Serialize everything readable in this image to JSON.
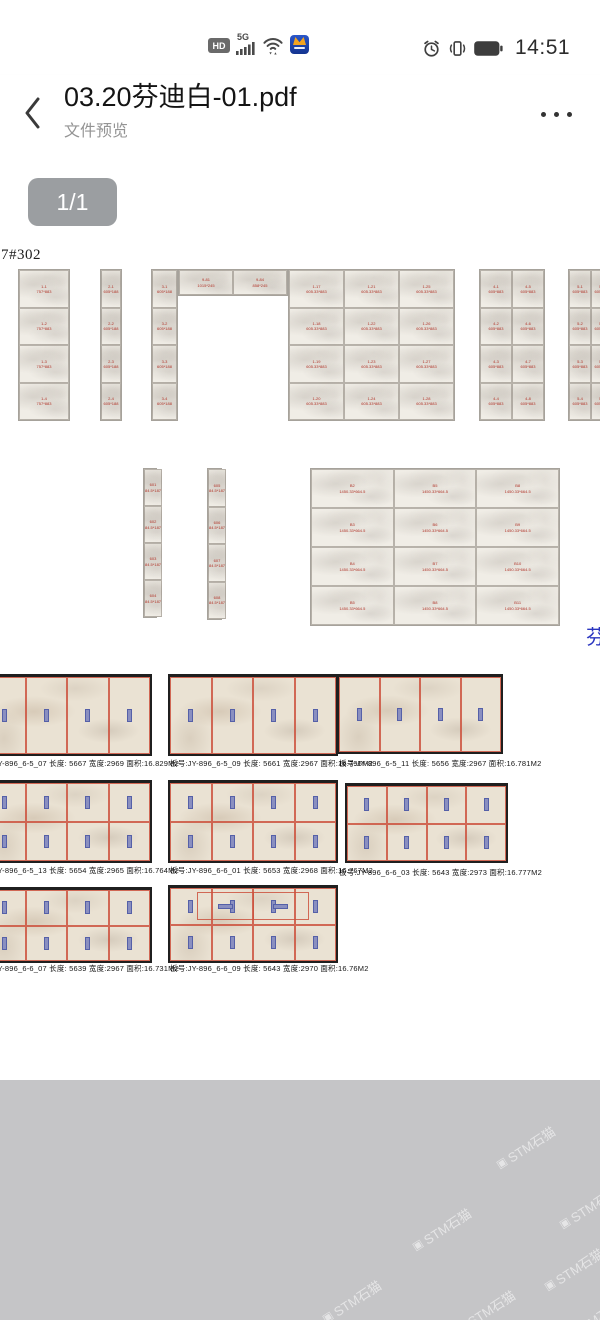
{
  "status_bar": {
    "time": "14:51",
    "hd_label": "HD",
    "network_label": "5G",
    "icons": [
      "hd-icon",
      "signal-bars-icon",
      "wifi-icon",
      "app-icon",
      "alarm-clock-icon",
      "vibrate-icon",
      "battery-icon"
    ]
  },
  "header": {
    "title": "03.20芬迪白-01.pdf",
    "subtitle": "文件预览"
  },
  "page_badge": "1/1",
  "drawing": {
    "corner_label": "07#302",
    "side_char": "芬",
    "tile_groups": [
      {
        "id": "panel-a",
        "x": 18,
        "y": 118,
        "w": 52,
        "h": 152,
        "cols": 1,
        "rows": 4,
        "labels": [
          "1-1\n757*883",
          "1-2\n757*883",
          "1-3\n757*883",
          "1-4\n757*883"
        ]
      },
      {
        "id": "panel-b",
        "x": 100,
        "y": 118,
        "w": 22,
        "h": 152,
        "cols": 1,
        "rows": 4,
        "labels": [
          "2-1\n605*188",
          "2-2\n605*188",
          "2-3\n605*188",
          "2-4\n605*188"
        ]
      },
      {
        "id": "door-left",
        "x": 151,
        "y": 118,
        "w": 27,
        "h": 152,
        "cols": 1,
        "rows": 4,
        "labels": [
          "3-1\n605*188",
          "3-2\n605*188",
          "3-3\n605*188",
          "3-4\n605*188"
        ]
      },
      {
        "id": "door-top",
        "x": 178,
        "y": 118,
        "w": 110,
        "h": 27,
        "cols": 2,
        "rows": 1,
        "labels": [
          "9-81\n1015*245",
          "9-84\n858*245"
        ]
      },
      {
        "id": "wall-main",
        "x": 288,
        "y": 118,
        "w": 167,
        "h": 152,
        "cols": 3,
        "rows": 4,
        "labels": [
          "1-17\n605.33*883",
          "1-21\n605.33*883",
          "1-25\n605.33*883",
          "1-18\n605.33*883",
          "1-22\n605.33*883",
          "1-26\n605.33*883",
          "1-19\n605.33*883",
          "1-23\n605.33*883",
          "1-27\n605.33*883",
          "1-20\n605.33*883",
          "1-24\n605.33*883",
          "1-28\n605.33*883"
        ]
      },
      {
        "id": "panel-d",
        "x": 479,
        "y": 118,
        "w": 66,
        "h": 152,
        "cols": 2,
        "rows": 4,
        "labels": [
          "4-1\n605*883",
          "4-5\n605*883",
          "4-2\n605*883",
          "4-6\n605*883",
          "4-3\n605*883",
          "4-7\n605*883",
          "4-4\n605*883",
          "4-8\n605*883"
        ]
      },
      {
        "id": "panel-e",
        "x": 568,
        "y": 118,
        "w": 46,
        "h": 152,
        "cols": 2,
        "rows": 4,
        "labels": [
          "5-1\n605*883",
          "5-5\n605*883",
          "5-2\n605*883",
          "5-6\n605*883",
          "5-3\n605*883",
          "5-7\n605*883",
          "5-4\n605*883",
          "5-8\n605*883"
        ]
      },
      {
        "id": "strip-a",
        "x": 143,
        "y": 317,
        "w": 14,
        "h": 150,
        "cols": 1,
        "rows": 4,
        "labels": [
          "601\n84.5*187",
          "602\n84.5*187",
          "603\n84.5*187",
          "604\n84.5*187"
        ]
      },
      {
        "id": "strip-b",
        "x": 207,
        "y": 317,
        "w": 15,
        "h": 152,
        "cols": 1,
        "rows": 4,
        "labels": [
          "605\n84.5*187",
          "606\n84.5*187",
          "607\n84.5*187",
          "608\n84.5*187"
        ]
      },
      {
        "id": "wall-lower",
        "x": 310,
        "y": 317,
        "w": 250,
        "h": 158,
        "cols": 3,
        "rows": 4,
        "labels": [
          "B2\n1450.33*664.5",
          "B5\n1450.33*664.5",
          "B8\n1450.33*664.5",
          "B3\n1450.33*664.5",
          "B6\n1450.33*664.5",
          "B9\n1450.33*664.5",
          "B4\n1450.33*664.5",
          "B7\n1450.33*664.5",
          "B10\n1450.33*664.5",
          "B5\n1450.33*664.5",
          "B8\n1450.33*664.5",
          "B11\n1450.33*664.5"
        ]
      }
    ]
  },
  "slabs": {
    "photos": [
      {
        "x": -18,
        "y": 523,
        "w": 170,
        "h": 82,
        "rows": 1,
        "cols": 4,
        "special": false
      },
      {
        "x": 168,
        "y": 523,
        "w": 170,
        "h": 82,
        "rows": 1,
        "cols": 4,
        "special": false
      },
      {
        "x": 337,
        "y": 523,
        "w": 166,
        "h": 80,
        "rows": 1,
        "cols": 4,
        "special": false
      },
      {
        "x": -18,
        "y": 629,
        "w": 170,
        "h": 83,
        "rows": 2,
        "cols": 4,
        "special": false
      },
      {
        "x": 168,
        "y": 629,
        "w": 170,
        "h": 83,
        "rows": 2,
        "cols": 4,
        "special": false
      },
      {
        "x": 345,
        "y": 632,
        "w": 163,
        "h": 80,
        "rows": 2,
        "cols": 4,
        "special": false
      },
      {
        "x": -18,
        "y": 736,
        "w": 170,
        "h": 76,
        "rows": 2,
        "cols": 4,
        "special": false
      },
      {
        "x": 168,
        "y": 734,
        "w": 170,
        "h": 78,
        "rows": 2,
        "cols": 4,
        "special": true
      }
    ],
    "captions": [
      {
        "x": -24,
        "y": 607,
        "text": "板号:JY-896_6-5_07 长度: 5667 宽度:2969 面积:16.829M2"
      },
      {
        "x": 170,
        "y": 607,
        "text": "板号:JY-896_6-5_09 长度: 5661 宽度:2967 面积:16.796M2"
      },
      {
        "x": 339,
        "y": 607,
        "text": "板号:JY-896_6-5_11 长度: 5656 宽度:2967 面积:16.781M2"
      },
      {
        "x": -24,
        "y": 714,
        "text": "板号:JY-896_6-5_13 长度: 5654 宽度:2965 面积:16.764M2"
      },
      {
        "x": 170,
        "y": 714,
        "text": "板号:JY-896_6-6_01 长度: 5653 宽度:2968 面积:16.767M2"
      },
      {
        "x": 339,
        "y": 716,
        "text": "板号:JY-896_6-6_03 长度: 5643 宽度:2973 面积:16.777M2"
      },
      {
        "x": -24,
        "y": 812,
        "text": "板号:JY-896_6-6_07 长度: 5639 宽度:2967 面积:16.731M2"
      },
      {
        "x": 170,
        "y": 812,
        "text": "板号:JY-896_6-6_09 长度: 5643 宽度:2970 面积:16.76M2"
      }
    ]
  },
  "watermark": {
    "icon": "▣",
    "text": "STM石猫",
    "positions": [
      {
        "x": 492,
        "y": 58
      },
      {
        "x": 555,
        "y": 118
      },
      {
        "x": 408,
        "y": 140
      },
      {
        "x": 540,
        "y": 180
      },
      {
        "x": 318,
        "y": 212
      },
      {
        "x": 452,
        "y": 222
      },
      {
        "x": 558,
        "y": 232
      }
    ]
  },
  "colors": {
    "badge_bg": "#9b9ea1",
    "tile_label_red": "#b13328",
    "grid_red": "#cd523e",
    "mark_blue": "#8a8fc0",
    "side_char_blue": "#2a35c0",
    "footer_gray": "#c5c5c7"
  }
}
